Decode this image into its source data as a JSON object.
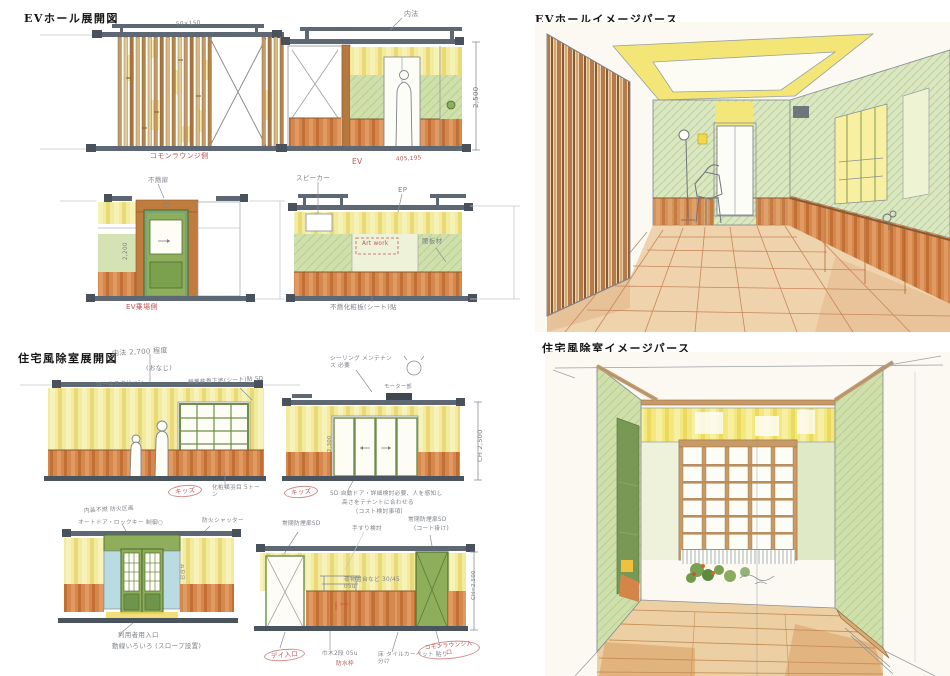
{
  "colors": {
    "paper": "#fbf9f2",
    "steel_beam": "#5d6874",
    "pencil": "#8a8f94",
    "annotation_red": "#c05555",
    "yellow_wall": "#f2eb9e",
    "green_wall": "#cfe0ad",
    "green_door": "#8fae5c",
    "orange_wainscot": "#d5884e",
    "slat_tan": "#c49a66",
    "slat_brown": "#a9763f",
    "blue_panel": "#b8dce2",
    "floor_tile": "#efd3ac",
    "wood_floor": "#ecd0a4"
  },
  "sections": {
    "ev_elev": {
      "title": "EVホール展開図",
      "ann": {
        "a_track_note": "50×150",
        "a_side_label": "コモンラウンジ側",
        "b_uchinori": "内法",
        "b_dim": "2,500",
        "b_ev_label": "EV",
        "b_num_label": "405,195",
        "c_top_note": "不燃扉",
        "c_dim": "2,200",
        "c_side_label": "EV乗場側",
        "d_speaker": "スピーカー",
        "d_ep": "EP",
        "d_koshi": "腰板材",
        "d_artwork": "Art work",
        "d_bottom": "不燃化粧板(シート)貼"
      }
    },
    "ev_persp": {
      "title": "EVホールイメージパース"
    },
    "vest_elev": {
      "title": "住宅風除室展開図",
      "ann": {
        "e_uchinori": "内法 2,700 程度",
        "e_onaji": "(おなじ)",
        "e_roll": "ロールスクリーン",
        "e_kids": "キッズ",
        "e_yokohame": "化粧横羽目 5トーン",
        "f_keiryo": "軽量鉄骨下地(シート)貼 SD",
        "f_seal": "シーリング メンテナンス 必要",
        "f_motor": "モーター部",
        "f_kids": "キッズ",
        "f_dim": "CH 2,500",
        "f_door_h": "2,300",
        "f_note1": "SD 自動ドア・詳細検討必要、人を感知し",
        "f_note2": "高さをテナントに合わせる",
        "f_note3": "(コスト検討事項)",
        "g_note1": "内装不燃 防火区画",
        "g_note2": "オートドア・ロックキー 制御○",
        "g_shutter": "防火シャッター",
        "g_meet": "召合せ",
        "g_entry": "利用者用入口",
        "g_slope": "動線いろいろ (スロープ設置)",
        "h_sd_left": "常閉防煙扉SD",
        "h_tesuri": "手すり検討",
        "h_sd_right": "常閉防煙扉SD",
        "h_coat": "(コート掛け)",
        "h_shelf": "荷物置台など 30/45 05u",
        "h_dim": "CH=2,500",
        "h_day": "デイ入口",
        "h_habaki": "巾木2段 05u",
        "h_bousui": "防水枠",
        "h_floor": "床 タイルカーペット 貼り分け",
        "h_lounge": "コモンラウンジ入口"
      }
    },
    "vest_persp": {
      "title": "住宅風除室イメージパース"
    }
  }
}
